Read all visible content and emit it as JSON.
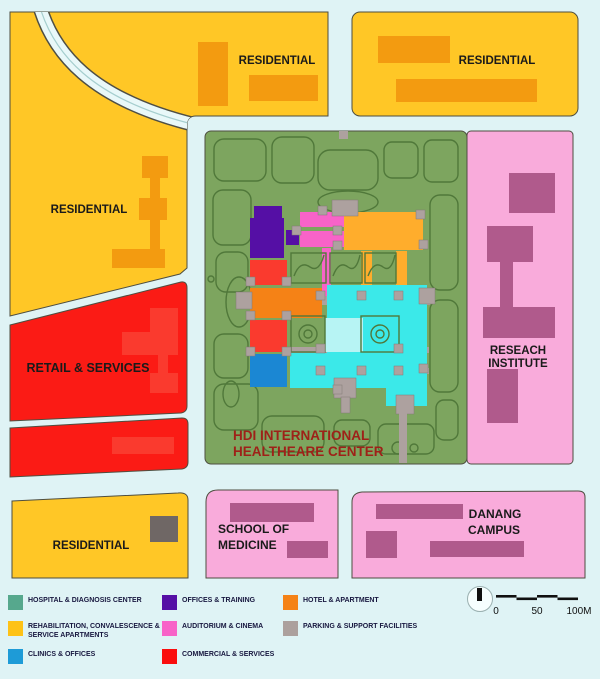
{
  "map": {
    "colors": {
      "bg": "#DFF3F5",
      "road": "#E9F8F9",
      "yellow": "#FFC726",
      "orange_bld": "#F39B10",
      "red": "#FB1B15",
      "red_bld": "#FA3A2E",
      "green": "#7DA55F",
      "green_path": "#50783A",
      "pink": "#F9ABDB",
      "mauve": "#B05A8C",
      "purple": "#550FA5",
      "magenta": "#F863C8",
      "amber": "#FFAD2C",
      "hotel_orange": "#F58216",
      "cyan": "#3BE9E9",
      "cyan_light": "#B7F4F4",
      "blue": "#1B87D3",
      "gray_bld": "#6F6765",
      "corridor": "#ADA19F",
      "label": "#1A1A1A",
      "hdi_label": "#9E2118"
    },
    "zones": {
      "residential_left": {
        "label": "RESIDENTIAL"
      },
      "residential_top_left": {
        "label": "RESIDENTIAL"
      },
      "residential_top_right": {
        "label": "RESIDENTIAL"
      },
      "residential_bottom": {
        "label": "RESIDENTIAL"
      },
      "retail": {
        "label": "RETAIL & SERVICES"
      },
      "healthcare_center": {
        "line1": "HDI INTERNATIONAL",
        "line2": "HEALTHEARE CENTER"
      },
      "research_institute": {
        "line1": "RESEACH",
        "line2": "INSTITUTE"
      },
      "school_of_medicine": {
        "line1": "SCHOOL OF",
        "line2": "MEDICINE"
      },
      "danang_campus": {
        "line1": "DANANG",
        "line2": "CAMPUS"
      }
    }
  },
  "legend": {
    "items": [
      {
        "label": "HOSPITAL & DIAGNOSIS CENTER",
        "color": "#56A88D"
      },
      {
        "label": "REHABILITATION, CONVALESCENCE & SERVICE APARTMENTS",
        "color": "#FEC217"
      },
      {
        "label": "CLINICS & OFFICES",
        "color": "#1E9BD7"
      },
      {
        "label": "OFFICES & TRAINING",
        "color": "#550FA5"
      },
      {
        "label": "AUDITORIUM & CINEMA",
        "color": "#F863C8"
      },
      {
        "label": "COMMERCIAL & SERVICES",
        "color": "#FA0D0D"
      },
      {
        "label": "HOTEL & APARTMENT",
        "color": "#F58216"
      },
      {
        "label": "PARKING & SUPPORT FACILITIES",
        "color": "#ACA09D"
      }
    ],
    "scale": {
      "t0": "0",
      "t50": "50",
      "t100": "100M"
    }
  }
}
